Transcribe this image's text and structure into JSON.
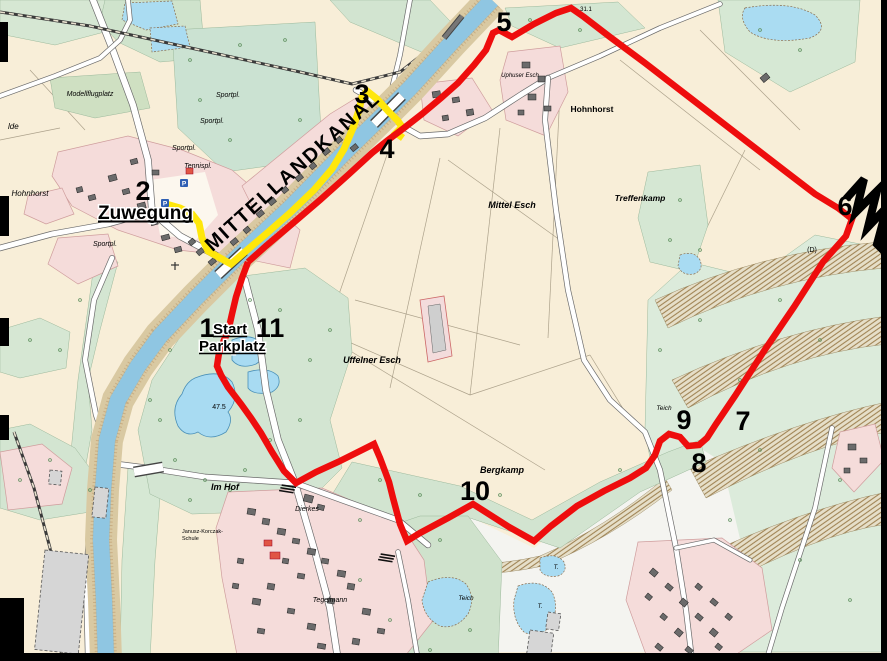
{
  "map": {
    "title": "Radwanderkarte Mittellandkanal Rundkurs",
    "colors": {
      "route_red": "#ee0d0d",
      "route_yellow": "#ffe70a",
      "water": "#a6d8f0",
      "land": "#f8eed8",
      "annotation": "#000000",
      "parking_blue": "#2f5fb3"
    },
    "canal_label": {
      "text": "MITTELLANDKANAL",
      "x": 297,
      "y": 176,
      "size": 20,
      "rotate": -42,
      "spacing": 2
    },
    "route_annotations": [
      {
        "id": "zuwegung",
        "text": "Zuwegung",
        "x": 98,
        "y": 219,
        "size": 19,
        "bold": true,
        "underline": true
      },
      {
        "id": "start",
        "text": "Start",
        "x": 213,
        "y": 334,
        "size": 15,
        "bold": true,
        "underline": true
      },
      {
        "id": "parkplatz",
        "text": "Parkplatz",
        "x": 199,
        "y": 351,
        "size": 15,
        "bold": true,
        "underline": true
      }
    ],
    "waypoints": [
      {
        "n": "1",
        "x": 207,
        "y": 337
      },
      {
        "n": "2",
        "x": 143,
        "y": 200
      },
      {
        "n": "3",
        "x": 362,
        "y": 103
      },
      {
        "n": "4",
        "x": 387,
        "y": 158
      },
      {
        "n": "5",
        "x": 504,
        "y": 31
      },
      {
        "n": "6",
        "x": 845,
        "y": 215
      },
      {
        "n": "7",
        "x": 743,
        "y": 430
      },
      {
        "n": "8",
        "x": 699,
        "y": 472
      },
      {
        "n": "9",
        "x": 684,
        "y": 429
      },
      {
        "n": "10",
        "x": 475,
        "y": 500
      },
      {
        "n": "11",
        "x": 270,
        "y": 337
      }
    ],
    "place_labels": [
      {
        "text": "Modellflugplatz",
        "x": 90,
        "y": 96,
        "size": 7,
        "italic": true
      },
      {
        "text": "Sportpl.",
        "x": 228,
        "y": 97,
        "size": 7,
        "italic": true
      },
      {
        "text": "Sportpl.",
        "x": 212,
        "y": 123,
        "size": 7,
        "italic": true
      },
      {
        "text": "Sportpl.",
        "x": 184,
        "y": 150,
        "size": 7,
        "italic": true
      },
      {
        "text": "Tennispl.",
        "x": 198,
        "y": 168,
        "size": 7,
        "italic": true
      },
      {
        "text": "Sportpl.",
        "x": 105,
        "y": 246,
        "size": 7,
        "italic": true
      },
      {
        "text": "Hohnhorst",
        "x": 30,
        "y": 196,
        "size": 8,
        "italic": true
      },
      {
        "text": "lde",
        "x": 8,
        "y": 129,
        "size": 8,
        "italic": true
      },
      {
        "text": "Hohnhorst",
        "x": 592,
        "y": 112,
        "size": 8.5,
        "bold": true
      },
      {
        "text": "Uphuser Esch",
        "x": 520,
        "y": 77,
        "size": 6,
        "italic": true
      },
      {
        "text": "Mittel Esch",
        "x": 512,
        "y": 208,
        "size": 9,
        "italic": true,
        "bold": true
      },
      {
        "text": "Treffenkamp",
        "x": 640,
        "y": 201,
        "size": 8.5,
        "italic": true,
        "bold": true
      },
      {
        "text": "Uffelner Esch",
        "x": 372,
        "y": 363,
        "size": 9,
        "italic": true,
        "bold": true
      },
      {
        "text": "Im Hof",
        "x": 225,
        "y": 490,
        "size": 9,
        "italic": true,
        "bold": true
      },
      {
        "text": "Bergkamp",
        "x": 502,
        "y": 473,
        "size": 9,
        "italic": true,
        "bold": true
      },
      {
        "text": "Dierkes",
        "x": 307,
        "y": 511,
        "size": 7,
        "italic": true
      },
      {
        "text": "Tegelmann",
        "x": 330,
        "y": 602,
        "size": 7,
        "italic": true
      },
      {
        "text": "Teich",
        "x": 664,
        "y": 410,
        "size": 6.5,
        "italic": true
      },
      {
        "text": "Teich",
        "x": 466,
        "y": 600,
        "size": 6.5,
        "italic": true
      },
      {
        "text": "T.",
        "x": 556,
        "y": 569,
        "size": 6,
        "italic": true
      },
      {
        "text": "T.",
        "x": 540,
        "y": 608,
        "size": 6,
        "italic": true
      },
      {
        "text": "47.5",
        "x": 219,
        "y": 409,
        "size": 7
      },
      {
        "text": "(D)",
        "x": 812,
        "y": 252,
        "size": 7
      },
      {
        "text": "31.1",
        "x": 586,
        "y": 11,
        "size": 6
      },
      {
        "text": "Janusz-Korczak-",
        "x": 182,
        "y": 533,
        "size": 5.5
      },
      {
        "text": "Schule",
        "x": 182,
        "y": 540,
        "size": 5.5
      }
    ],
    "routes": {
      "red": {
        "color": "#ee0d0d",
        "width": 6.5,
        "points": [
          [
            248,
            262
          ],
          [
            266,
            246
          ],
          [
            292,
            224
          ],
          [
            320,
            200
          ],
          [
            348,
            175
          ],
          [
            372,
            153
          ],
          [
            388,
            140
          ],
          [
            404,
            128
          ],
          [
            422,
            114
          ],
          [
            441,
            98
          ],
          [
            458,
            83
          ],
          [
            474,
            65
          ],
          [
            486,
            50
          ],
          [
            493,
            33
          ],
          [
            499,
            30
          ],
          [
            512,
            37
          ],
          [
            534,
            24
          ],
          [
            556,
            13
          ],
          [
            571,
            8
          ],
          [
            584,
            17
          ],
          [
            610,
            37
          ],
          [
            645,
            63
          ],
          [
            680,
            90
          ],
          [
            715,
            117
          ],
          [
            750,
            144
          ],
          [
            785,
            171
          ],
          [
            815,
            194
          ],
          [
            838,
            208
          ],
          [
            852,
            219
          ],
          [
            846,
            236
          ],
          [
            823,
            262
          ],
          [
            794,
            307
          ],
          [
            764,
            351
          ],
          [
            735,
            396
          ],
          [
            716,
            424
          ],
          [
            707,
            438
          ],
          [
            699,
            445
          ],
          [
            688,
            446
          ],
          [
            680,
            437
          ],
          [
            669,
            434
          ],
          [
            660,
            441
          ],
          [
            655,
            455
          ],
          [
            646,
            468
          ],
          [
            630,
            478
          ],
          [
            604,
            491
          ],
          [
            577,
            506
          ],
          [
            551,
            526
          ],
          [
            534,
            541
          ],
          [
            509,
            527
          ],
          [
            473,
            504
          ],
          [
            448,
            518
          ],
          [
            420,
            533
          ],
          [
            407,
            541
          ],
          [
            400,
            524
          ],
          [
            393,
            498
          ],
          [
            389,
            482
          ],
          [
            380,
            458
          ],
          [
            374,
            444
          ],
          [
            362,
            450
          ],
          [
            338,
            462
          ],
          [
            316,
            472
          ],
          [
            296,
            483
          ],
          [
            284,
            471
          ],
          [
            272,
            452
          ],
          [
            261,
            433
          ],
          [
            251,
            418
          ],
          [
            241,
            404
          ],
          [
            228,
            387
          ],
          [
            221,
            375
          ],
          [
            217,
            366
          ],
          [
            219,
            353
          ],
          [
            224,
            340
          ],
          [
            228,
            332
          ],
          [
            232,
            314
          ],
          [
            236,
            297
          ],
          [
            242,
            278
          ],
          [
            248,
            262
          ]
        ]
      },
      "yellow": {
        "color": "#ffe70a",
        "width": 7,
        "points": [
          [
            166,
            204
          ],
          [
            180,
            208
          ],
          [
            192,
            214
          ],
          [
            199,
            223
          ],
          [
            202,
            238
          ],
          [
            208,
            251
          ],
          [
            220,
            258
          ],
          [
            231,
            264
          ],
          [
            246,
            251
          ],
          [
            266,
            234
          ],
          [
            290,
            213
          ],
          [
            314,
            190
          ],
          [
            332,
            169
          ],
          [
            344,
            149
          ],
          [
            353,
            128
          ],
          [
            359,
            110
          ],
          [
            362,
            97
          ],
          [
            367,
            91
          ],
          [
            377,
            99
          ],
          [
            389,
            112
          ],
          [
            398,
            121
          ],
          [
            402,
            127
          ],
          [
            396,
            133
          ],
          [
            403,
            138
          ]
        ]
      }
    },
    "symbols": {
      "parking": {
        "letter": "P",
        "color": "#2f5fb3",
        "positions": [
          [
            184,
            183
          ],
          [
            165,
            203
          ]
        ]
      },
      "lightning_mark": {
        "color": "#000000",
        "path": "M846,199 L864,179 L856,212 L877,191 L868,227 L887,207 L877,244 L887,254"
      }
    }
  }
}
